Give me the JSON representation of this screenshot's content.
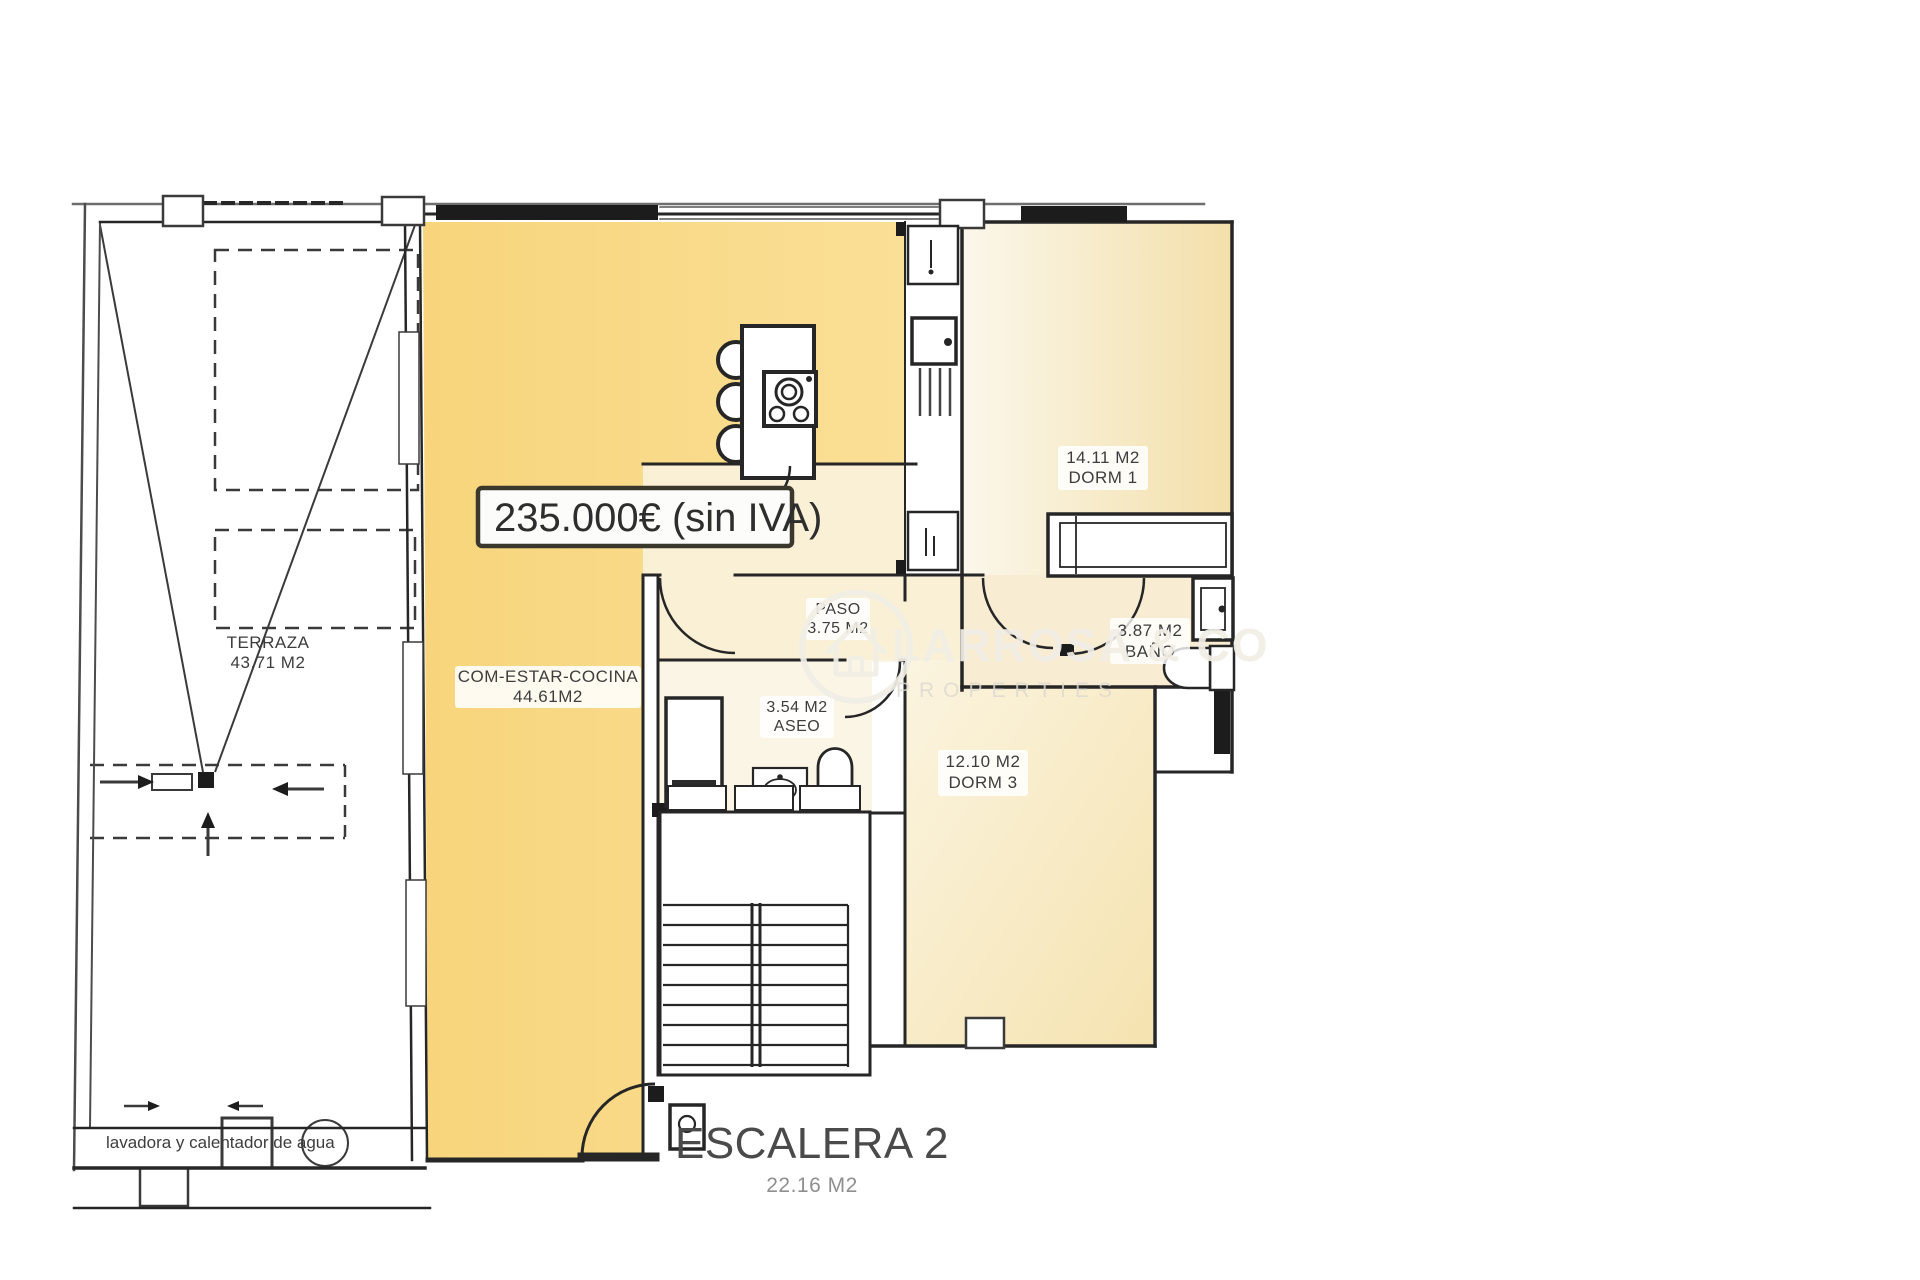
{
  "plan": {
    "price_tag": "235.000€ (sin IVA)",
    "watermark": {
      "name": "LARROSA & CO",
      "tagline": "PROPERTIES"
    },
    "rooms": {
      "terraza": {
        "name": "TERRAZA",
        "area": "43.71 M2"
      },
      "living": {
        "name": "COM-ESTAR-COCINA",
        "area": "44.61M2"
      },
      "paso": {
        "name": "PASO",
        "area": "3.75 M2"
      },
      "aseo": {
        "name": "ASEO",
        "area": "3.54 M2"
      },
      "dorm1": {
        "name": "DORM 1",
        "area": "14.11 M2"
      },
      "bano": {
        "name": "BAÑO",
        "area": "3.87 M2"
      },
      "dorm3": {
        "name": "DORM 3",
        "area": "12.10 M2"
      },
      "escalera": {
        "name": "ESCALERA 2",
        "area": "22.16 M2"
      }
    },
    "annotations": {
      "laundry_note": "lavadora y calentador de agua"
    },
    "colors": {
      "living_fill": "#F8D57C",
      "hall_fill": "#FAF0D6",
      "aseo_fill": "#FBF5E6",
      "bath_fill": "#F8EDD3",
      "dorm1_fill_light": "#FBF7EB",
      "dorm1_fill_dark": "#F3DFA9",
      "dorm3_fill_light": "#FBF4E0",
      "dorm3_fill_dark": "#F5E3B0",
      "wall": "#262626",
      "label_text": "#3D3D3D",
      "faded_text": "#8F8F8F",
      "watermark": "#F1EEE6",
      "price_border": "#3A372C",
      "price_text": "#2E2E2E"
    }
  }
}
